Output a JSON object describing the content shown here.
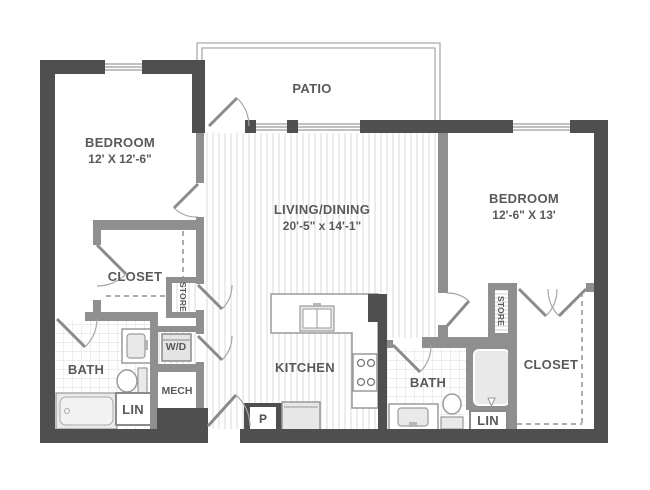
{
  "floorplan": {
    "type": "apartment-floor-plan",
    "rooms": {
      "patio": {
        "label": "PATIO"
      },
      "bedroom_left": {
        "label": "BEDROOM",
        "dims": "12' X 12'-6\""
      },
      "living": {
        "label": "LIVING/DINING",
        "dims": "20'-5\" x 14'-1\""
      },
      "bedroom_right": {
        "label": "BEDROOM",
        "dims": "12'-6\" X 13'"
      },
      "closet_left": {
        "label": "CLOSET"
      },
      "store_left": {
        "label": "STORE"
      },
      "bath_left": {
        "label": "BATH"
      },
      "wd": {
        "label": "W/D"
      },
      "mech": {
        "label": "MECH"
      },
      "lin_left": {
        "label": "LIN"
      },
      "kitchen": {
        "label": "KITCHEN"
      },
      "pantry": {
        "label": "P"
      },
      "bath_right": {
        "label": "BATH"
      },
      "lin_right": {
        "label": "LIN"
      },
      "store_right": {
        "label": "STORE"
      },
      "closet_right": {
        "label": "CLOSET"
      }
    },
    "colors": {
      "wall_dark": "#4f4f4f",
      "wall_interior": "#8f8f8f",
      "label_text": "#595959",
      "fixture_fill": "#e9e9e9",
      "floor_hatch": "#d9d9d9",
      "bath_tile": "#dedede"
    }
  }
}
